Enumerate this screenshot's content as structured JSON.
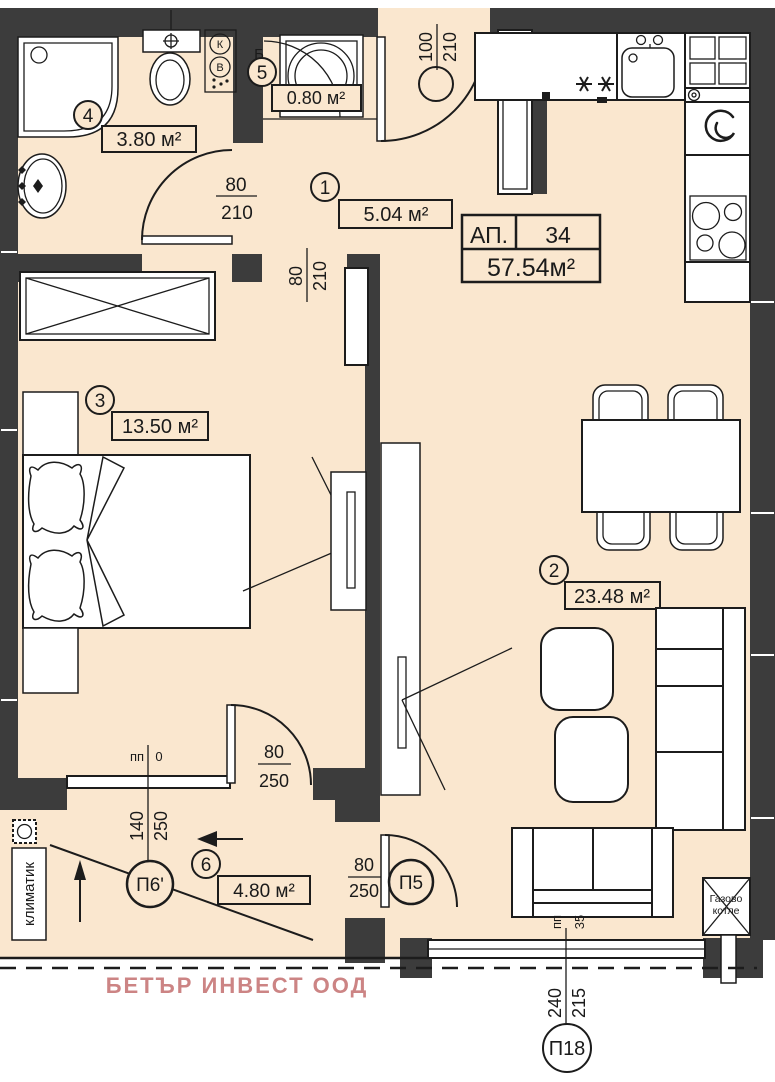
{
  "apartment_card": {
    "label": "АП.",
    "number": "34",
    "total_area": "57.54м²"
  },
  "rooms": [
    {
      "num": "1",
      "area": "5.04 м²"
    },
    {
      "num": "2",
      "area": "23.48 м²"
    },
    {
      "num": "3",
      "area": "13.50 м²"
    },
    {
      "num": "4",
      "area": "3.80 м²"
    },
    {
      "num": "5",
      "area": "0.80 м²"
    },
    {
      "num": "6",
      "area": "4.80 м²"
    }
  ],
  "doors": {
    "entrance": {
      "w": "100",
      "h": "210"
    },
    "bathroom": {
      "w": "80",
      "h": "210"
    },
    "bedroom": {
      "w": "80",
      "h": "210"
    },
    "bedroom_balcony": {
      "w": "80",
      "h": "250"
    },
    "living_balcony": {
      "w": "80",
      "h": "250"
    }
  },
  "windows": {
    "p6": {
      "id": "П6'",
      "w": "140",
      "h": "250",
      "sill_label": "пп",
      "sill_height": "0"
    },
    "p5": {
      "id": "П5"
    },
    "p18": {
      "id": "П18",
      "w": "240",
      "h": "215",
      "sill_label": "пп",
      "sill_height": "35"
    }
  },
  "labels": {
    "ac": "климатик",
    "boiler_line1": "Газово",
    "boiler_line2": "котле",
    "closet": "Б",
    "shaft_k": "К",
    "shaft_v": "В",
    "watermark": "БЕТЪР ИНВЕСТ ООД"
  },
  "colors": {
    "floor": "#fae7cf",
    "wall": "#3c3c3c",
    "line": "#1c1c1c",
    "watermark": "#cc8484"
  }
}
